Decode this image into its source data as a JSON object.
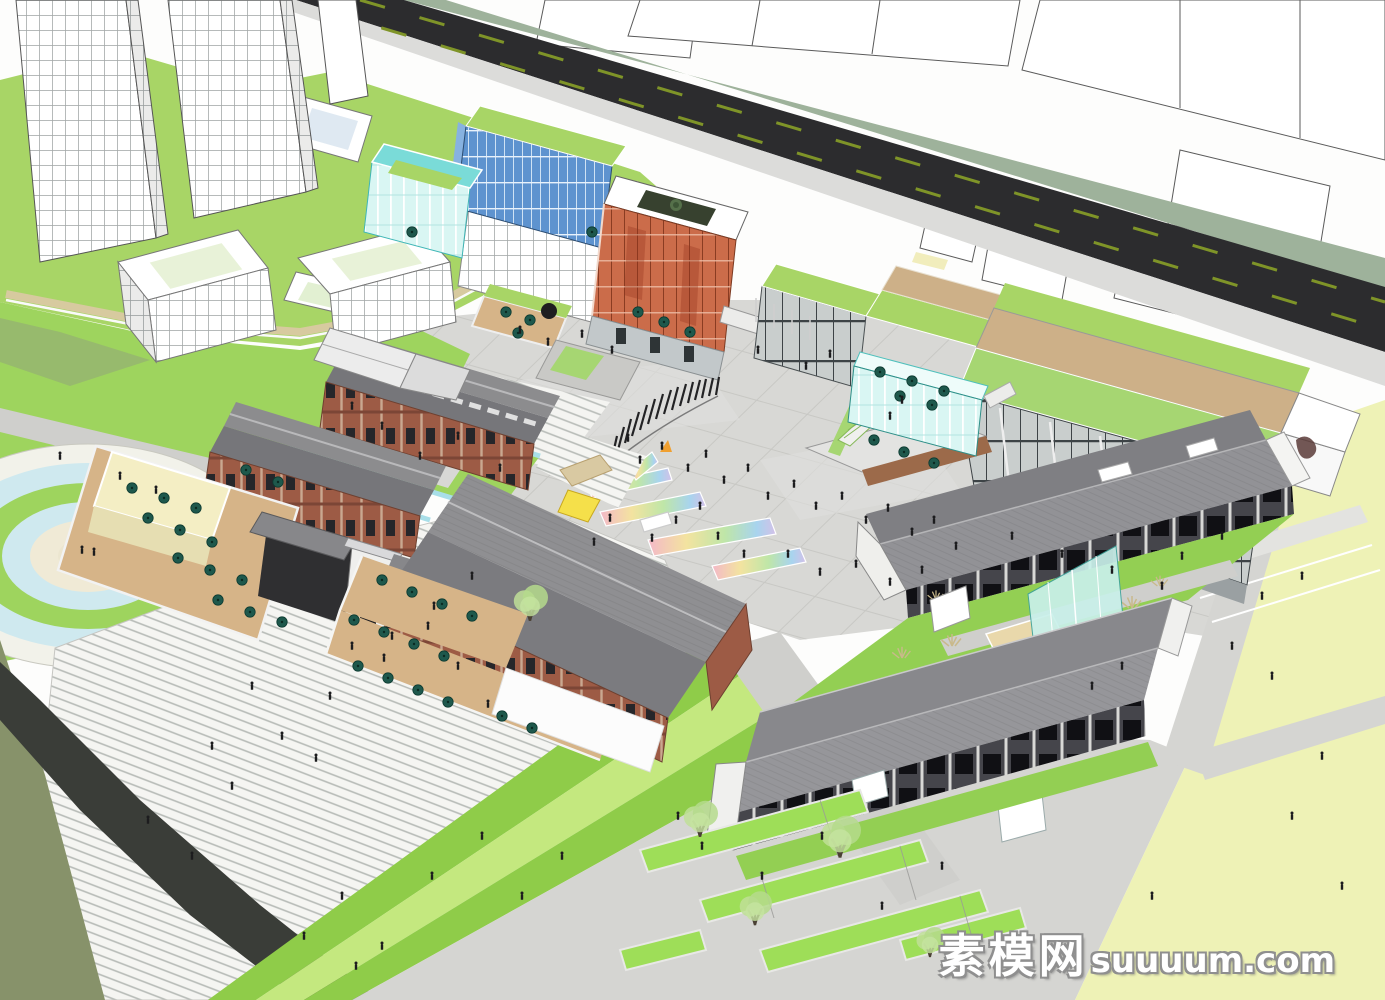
{
  "watermark": {
    "site_name_cn": "素模网",
    "site_domain": "suuuum.com"
  },
  "scene": {
    "kind": "3D architectural massing render (SketchUp style), aerial axonometric view",
    "subject": "Cultural-creative park / commercial block: renovated brick warehouses with dark pitched roofs, glass pavilions, orange atrium cube, roof gardens, central pedestrian plaza with art walls and curved pergola, amphitheater steps, circular fountain, hedge-maze garden and city road with high-rise context",
    "elements": [
      "highrise-towers",
      "roof-garden-podium",
      "background-buildings",
      "city-road",
      "blue-glass-building",
      "teal-glass-box",
      "orange-atrium-building",
      "annex-glass-box",
      "right-gallery-building",
      "central-plaza",
      "curved-pergola",
      "viewing-stage",
      "plaza-art-walls",
      "teal-cafe-pavilion",
      "sphere-sculpture",
      "warehouse-courtyard",
      "teal-crystal-sculpture",
      "west-cafe-terrace",
      "gate-house",
      "central-brick-warehouse",
      "roof-deck-cafe",
      "east-warehouse-north",
      "east-warehouse-south",
      "glass-atrium-wedge",
      "sand-court",
      "hedge-maze-garden",
      "circular-fountain",
      "amphitheater-steps",
      "lawn-bands",
      "olive-ground",
      "dark-footpath",
      "yellow-lawn-field",
      "pedestrians",
      "cafe-umbrellas",
      "trees",
      "watermark"
    ]
  },
  "palette": {
    "lawn_green": "#9ed45e",
    "bright_lawn": "#c4e87f",
    "roof_garden_green": "#a8d566",
    "pale_lawn_yellow": "#eef2b6",
    "plaza_gray": "#d8d8d5",
    "warehouse_roof_gray": "#8d8d90",
    "brick_red": "#9d5b45",
    "orange_glass": "#cb6c4a",
    "blue_glass": "#5e93cf",
    "teal_glass": "#7adbd8",
    "water_blue": "#bfe6ee",
    "asphalt": "#2c2c2e",
    "road_median_sage": "#9eb29b",
    "umbrella_teal": "#1e584c",
    "wood_deck_tan": "#d6b488",
    "olive_ground": "#87926a",
    "watermark_white": "#ffffff"
  }
}
